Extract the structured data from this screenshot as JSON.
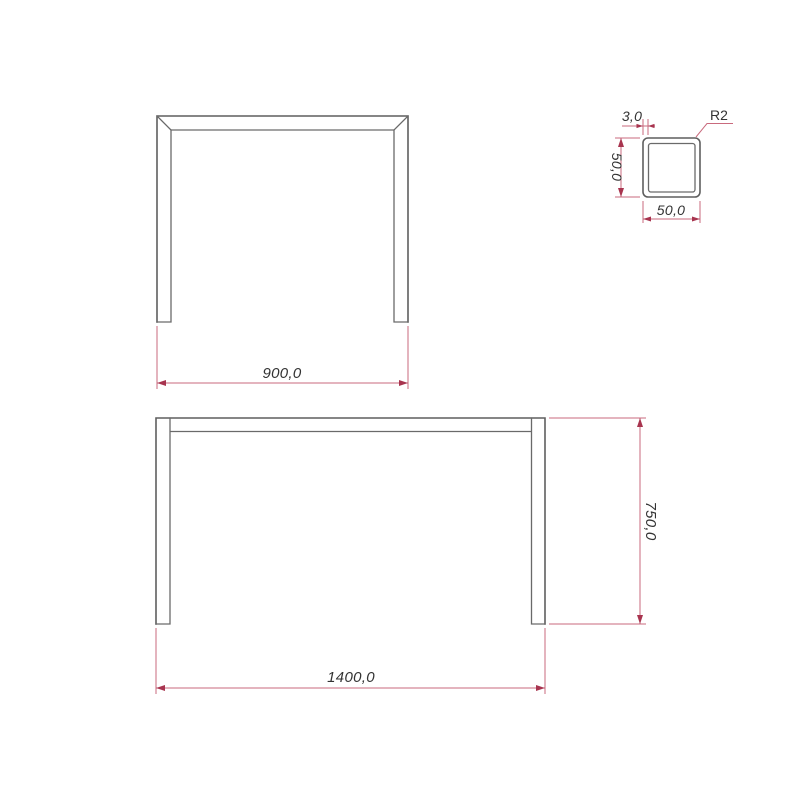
{
  "drawing": {
    "background_color": "#ffffff",
    "outline_color": "#5f5f5f",
    "dimension_line_color": "#c96a7d",
    "dimension_arrow_color": "#a8344f",
    "dimension_text_color": "#333333",
    "top_view": {
      "width": "900,0"
    },
    "front_view": {
      "width": "1400,0",
      "height": "750,0"
    },
    "section_view": {
      "wall_thickness": "3,0",
      "corner_radius": "R2",
      "height": "50,0",
      "width": "50,0"
    }
  }
}
